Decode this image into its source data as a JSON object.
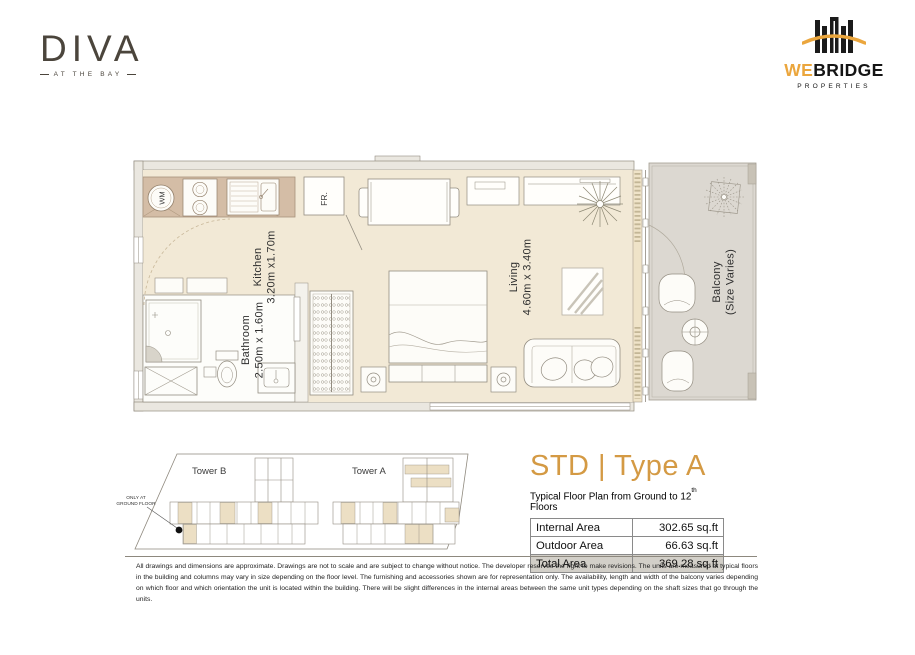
{
  "header": {
    "brand": {
      "name": "DIVA",
      "tagline": "AT THE BAY"
    },
    "developer": {
      "name_accent": "WE",
      "name_rest": "BRIDGE",
      "subtitle": "PROPERTIES"
    }
  },
  "floor_plan": {
    "rooms": {
      "kitchen": {
        "name": "Kitchen",
        "dims": "3.20m x1.70m"
      },
      "bathroom": {
        "name": "Bathroom",
        "dims": "2.50m x 1.60m"
      },
      "living": {
        "name": "Living",
        "dims": "4.60m x 3.40m"
      },
      "balcony": {
        "name": "Balcony",
        "dims": "(Size Varies)"
      }
    },
    "appliances": {
      "fridge": "FR.",
      "washing_machine": "WM"
    }
  },
  "site_plan": {
    "tower_b": "Tower B",
    "tower_a": "Tower A",
    "note_line1": "ONLY AT",
    "note_line2": "GROUND FLOOR"
  },
  "unit_info": {
    "title": "STD | Type A",
    "subtitle_prefix": "Typical Floor Plan from Ground to 12",
    "subtitle_sup": "th",
    "subtitle_suffix": " Floors",
    "table": {
      "rows": [
        {
          "label": "Internal Area",
          "value": "302.65 sq.ft"
        },
        {
          "label": "Outdoor Area",
          "value": "66.63 sq.ft"
        },
        {
          "label": "Total Area",
          "value": "369.28 sq.ft"
        }
      ]
    }
  },
  "disclaimer": "All drawings and dimensions are approximate. Drawings are not to scale and are subject to change without notice. The developer reserves the right to make revisions. The units are measured at typical floors in the building and columns may vary in size depending on the floor level. The furnishing and accessories shown are for representation only. The availability, length and width of the balcony varies depending on which floor and which orientation the unit is located within the building. There will be slight differences in the internal areas between the same unit types depending on the shaft sizes that go through the units.",
  "colors": {
    "accent_orange": "#d49a44",
    "developer_orange": "#eba63d",
    "brand_taupe": "#4b453c",
    "floor_beige": "#f2e9d6",
    "balcony_grey": "#dcd8d1",
    "highlight_beige": "#ecdfc4"
  }
}
